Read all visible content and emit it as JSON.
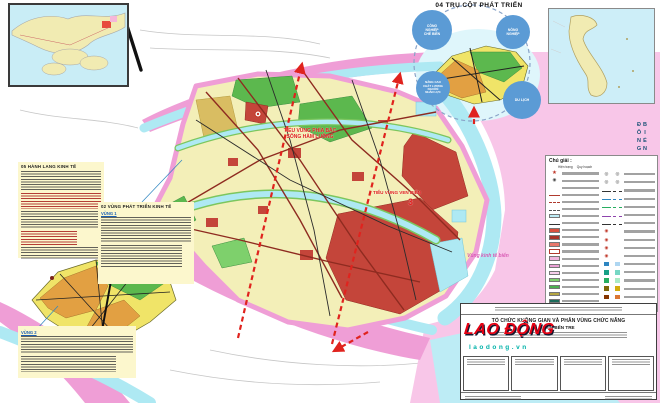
{
  "map_title": {
    "main": "TỔ CHỨC KHÔNG GIAN VÀ PHÂN VÙNG CHỨC NĂNG",
    "province": "TỈNH BẾN TRE"
  },
  "watermark": {
    "name": "LAO ĐỘNG",
    "domain": "laodong.vn",
    "red": "#e60012",
    "teal": "#00b2a9"
  },
  "diagram": {
    "title": "04 TRỤ CỘT PHÁT TRIỂN",
    "circle_color": "#5b9bd5",
    "pillars": [
      {
        "label": "CÔNG\nNGHIỆP\nCHẾ BIẾN"
      },
      {
        "label": "NÔNG\nNGHIỆP"
      },
      {
        "label": "NÂNG CAO\nCHẤT LƯỢNG\nNGUỒN\nNHÂN LỰC"
      },
      {
        "label": "DU LỊCH"
      }
    ]
  },
  "side_notes": {
    "corridors_title": "05 HÀNH LANG KINH TẾ",
    "zones_title": "02 VÙNG PHÁT TRIỂN KINH TẾ",
    "zone1_label": "VÙNG 1",
    "zone2_label": "VÙNG 2"
  },
  "map_labels": {
    "subregion_north": "TIỂU VÙNG PHÍA BẮC\nSÔNG HÀM LUÔNG",
    "subregion_coastal": "TIỂU VÙNG VEN BIỂN",
    "subregion_coastal_number": "3",
    "marine_zone": "Vùng kinh tế biển",
    "east_sea": "BIỂN ĐÔNG"
  },
  "legend": {
    "title": "Chú giải :",
    "col_existing": "Hiện trạng",
    "col_planned": "Quy hoạch",
    "left_rows": [
      {
        "kind": "star",
        "color": "#c0392b"
      },
      {
        "kind": "ring",
        "color": "#444"
      },
      {
        "kind": "none",
        "color": "#444"
      },
      {
        "kind": "line",
        "color": "#b03a2e"
      },
      {
        "kind": "dashline",
        "color": "#b03a2e"
      },
      {
        "kind": "dashline",
        "color": "#555555"
      },
      {
        "kind": "swatch",
        "color": "#bdecf5"
      },
      {
        "kind": "thinline",
        "color": "#333333"
      },
      {
        "kind": "swatch",
        "color": "#d94f3d"
      },
      {
        "kind": "swatch",
        "color": "#a93226"
      },
      {
        "kind": "swatch",
        "color": "#e8776a"
      },
      {
        "kind": "outline",
        "color": "#b03a2e"
      },
      {
        "kind": "swatch",
        "color": "#f0b4dd"
      },
      {
        "kind": "swatch",
        "color": "#e99fd4"
      },
      {
        "kind": "swatch",
        "color": "#f6cdea"
      },
      {
        "kind": "swatch",
        "color": "#7ed06c"
      },
      {
        "kind": "swatch",
        "color": "#4caf50"
      },
      {
        "kind": "swatch",
        "color": "#b5a642"
      },
      {
        "kind": "swatch",
        "color": "#1b6b5a"
      }
    ],
    "right_rows": [
      {
        "kind": "pair-ring"
      },
      {
        "kind": "pair-ring"
      },
      {
        "kind": "pair-line",
        "color": "#333333"
      },
      {
        "kind": "pair-line",
        "color": "#2e86c1"
      },
      {
        "kind": "pair-line",
        "color": "#27ae60"
      },
      {
        "kind": "pair-line",
        "color": "#8e44ad"
      },
      {
        "kind": "pair-line",
        "color": "#333333"
      },
      {
        "kind": "dot",
        "color": "#c0392b"
      },
      {
        "kind": "dot",
        "color": "#c0392b"
      },
      {
        "kind": "dot",
        "color": "#c0392b"
      },
      {
        "kind": "dot",
        "color": "#c0392b"
      },
      {
        "kind": "pair-square",
        "a": "#2e86c1",
        "b": "#aed6f1"
      },
      {
        "kind": "pair-square",
        "a": "#16a085",
        "b": "#76d7c4"
      },
      {
        "kind": "pair-square",
        "a": "#27ae60",
        "b": "#abebc6"
      },
      {
        "kind": "pair-square",
        "a": "#7d6608",
        "b": "#d4ac0d"
      },
      {
        "kind": "pair-square",
        "a": "#873600",
        "b": "#dc7633"
      }
    ]
  },
  "region_colors": {
    "province_base": "#f3efb8",
    "marine_zone_pink": "#f8c6e8",
    "boundary_pink": "#ef9ed6",
    "river_cyan": "#aee9f3",
    "agriculture_green": "#5cb84e",
    "urban_red": "#c4453a",
    "inset_orange": "#e2a042"
  }
}
